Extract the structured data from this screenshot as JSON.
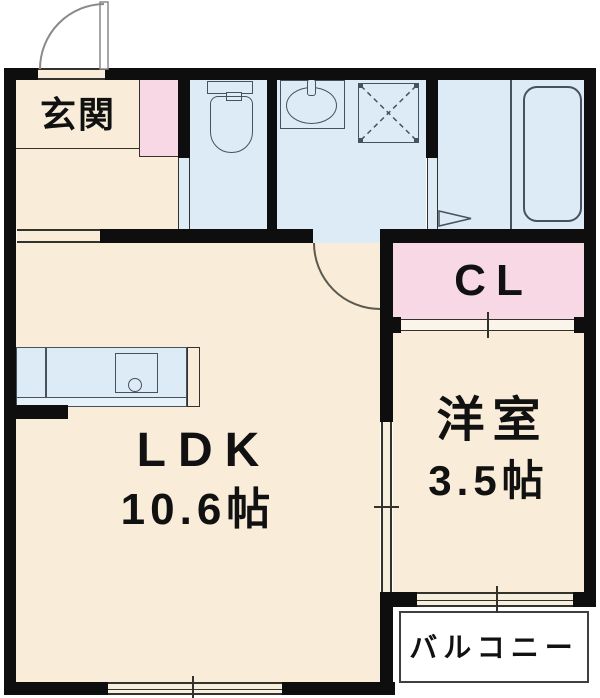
{
  "plan_title": "apartment-floor-plan",
  "rooms": {
    "genkan": {
      "label": "玄関"
    },
    "ldk": {
      "label": "LDK",
      "size": "10.6帖"
    },
    "western_room": {
      "label": "洋室",
      "size": "3.5帖"
    },
    "closet": {
      "label": "CL"
    },
    "balcony": {
      "label": "バルコニー"
    }
  },
  "fixtures": [
    "entrance-door-swing",
    "toilet",
    "washbasin",
    "washer-pan",
    "bathtub",
    "bathroom-folding-door",
    "kitchen-counter-with-sink",
    "closet-sliding-door",
    "room-sliding-door",
    "sliding-window-ldk",
    "sliding-window-western-room"
  ],
  "colors": {
    "wall": "#0e0e0e",
    "room_cream": "#f9ecd8",
    "wet_area_blue": "#dcebf5",
    "closet_pink": "#f8d8e5",
    "fixture_stroke": "#47525e",
    "text": "#111111"
  }
}
